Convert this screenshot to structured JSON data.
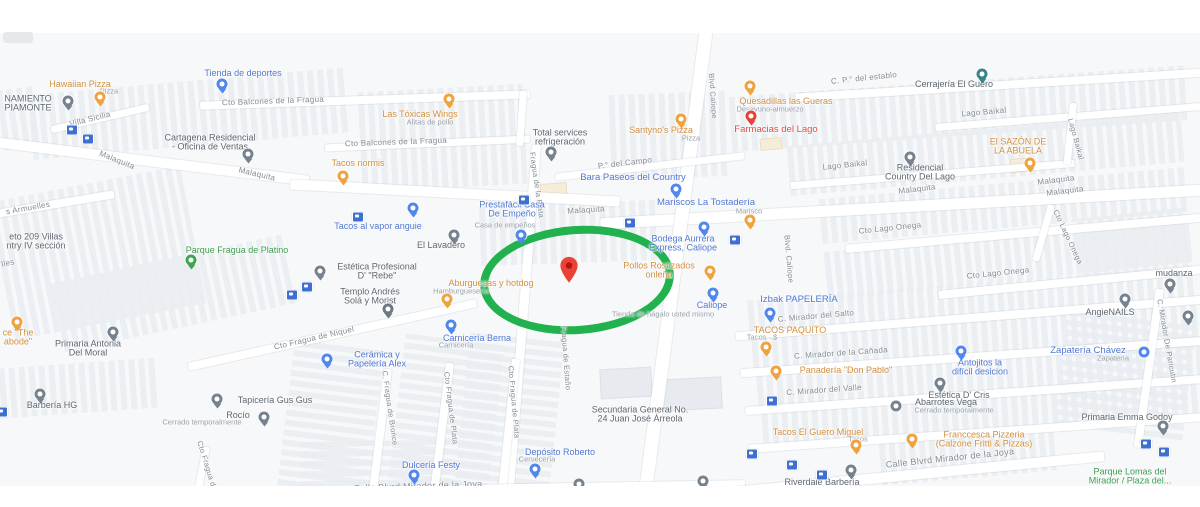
{
  "map": {
    "colors": {
      "background": "#f7f8fa",
      "road": "#ffffff",
      "street_label": "#828a94",
      "poi_food": "#d28f3e",
      "poi_shop": "#5077d2",
      "poi_generic": "#5d6670",
      "poi_red": "#df4b41",
      "poi_park": "#3d9c50",
      "highlight_circle": "#21b14e",
      "destination_marker": "#ea4335"
    },
    "streets": [
      {
        "t": "Villa Sicilia",
        "x": 90,
        "y": 86,
        "r": -14
      },
      {
        "t": "Cto Balcones de la Fragua",
        "x": 273,
        "y": 68,
        "r": -2
      },
      {
        "t": "Cto Balcones de la Fragua",
        "x": 396,
        "y": 109,
        "r": -2
      },
      {
        "t": "Malaquita",
        "x": 117,
        "y": 127,
        "r": 22
      },
      {
        "t": "Malaquita",
        "x": 257,
        "y": 141,
        "r": 13
      },
      {
        "t": "Malaquita",
        "x": 586,
        "y": 177,
        "r": -4
      },
      {
        "t": "Malaquita",
        "x": 917,
        "y": 156,
        "r": -7
      },
      {
        "t": "Malaquita",
        "x": 1056,
        "y": 147,
        "r": -7
      },
      {
        "t": "Malaquita",
        "x": 1065,
        "y": 158,
        "r": -7
      },
      {
        "t": "C. P.° del establo",
        "x": 864,
        "y": 45,
        "r": -6
      },
      {
        "t": "Lago Baikal",
        "x": 984,
        "y": 79,
        "r": -5
      },
      {
        "t": "Lago Baikal",
        "x": 845,
        "y": 132,
        "r": -6
      },
      {
        "t": "Cto Lago Onega",
        "x": 890,
        "y": 195,
        "r": -6
      },
      {
        "t": "Cto Lago Onega",
        "x": 998,
        "y": 240,
        "r": -6
      },
      {
        "t": "P.° del Campo",
        "x": 625,
        "y": 130,
        "r": -7
      },
      {
        "t": "s Armuelles",
        "x": 28,
        "y": 175,
        "r": -10
      },
      {
        "t": "lles",
        "x": 8,
        "y": 230,
        "r": -12
      },
      {
        "t": "Cto Fragua de Niquel",
        "x": 314,
        "y": 305,
        "r": -13
      },
      {
        "t": "Calle Blvrd Mirador de la Joya",
        "x": 418,
        "y": 453,
        "r": -2,
        "fs": 9
      },
      {
        "t": "Calle Blvrd Mirador de la Joya",
        "x": 950,
        "y": 425,
        "r": -6,
        "fs": 9
      },
      {
        "t": "C. Mirador del Salto",
        "x": 816,
        "y": 283,
        "r": -5
      },
      {
        "t": "C. Mirador de la Cañada",
        "x": 841,
        "y": 320,
        "r": -4
      },
      {
        "t": "C. Mirador del Valle",
        "x": 824,
        "y": 357,
        "r": -4
      },
      {
        "t": "Fragua de la Plata",
        "x": 537,
        "y": 152,
        "r": 82,
        "fs": 7.5
      },
      {
        "t": "Fragua de Estaño",
        "x": 566,
        "y": 325,
        "r": 86,
        "fs": 7.5
      },
      {
        "t": "C. Fragua de Bronce",
        "x": 390,
        "y": 375,
        "r": 82,
        "fs": 7.5
      },
      {
        "t": "Cto Fragua de Plata",
        "x": 451,
        "y": 375,
        "r": 83,
        "fs": 7.5
      },
      {
        "t": "Cto Fragua de Plata",
        "x": 514,
        "y": 369,
        "r": 85,
        "fs": 7.5
      },
      {
        "t": "Cto Fragua de Niquel",
        "x": 211,
        "y": 445,
        "r": 73,
        "fs": 7.5
      },
      {
        "t": "Blvd Caliope",
        "x": 713,
        "y": 63,
        "r": 86,
        "fs": 7.5
      },
      {
        "t": "Blvd. Caliope",
        "x": 789,
        "y": 226,
        "r": 85,
        "fs": 7.5
      },
      {
        "t": "Lago Baikal",
        "x": 1076,
        "y": 106,
        "r": 75,
        "fs": 7.5
      },
      {
        "t": "Cto Lago Onega",
        "x": 1068,
        "y": 204,
        "r": 65,
        "fs": 7.5
      },
      {
        "t": "C. Mirador De Paricutin",
        "x": 1167,
        "y": 308,
        "r": 80,
        "fs": 7.5
      }
    ],
    "pois": [
      {
        "type": "food",
        "t": [
          "Hawaiian Pizza"
        ],
        "x": 80,
        "y": 51,
        "sub": {
          "t": "Pizza",
          "x": 109,
          "y": 58
        },
        "pin": {
          "k": "food",
          "x": 100,
          "y": 64
        }
      },
      {
        "type": "food",
        "t": [
          "Las Tóxicas Wings"
        ],
        "x": 420,
        "y": 81,
        "sub": {
          "t": "Alitas de pollo",
          "x": 430,
          "y": 89
        },
        "pin": {
          "k": "food",
          "x": 449,
          "y": 66
        }
      },
      {
        "type": "food",
        "t": [
          "Tacos normis"
        ],
        "x": 358,
        "y": 130,
        "pin": {
          "k": "food",
          "x": 343,
          "y": 143
        }
      },
      {
        "type": "food",
        "t": [
          "Santyno's Pizza"
        ],
        "x": 661,
        "y": 97,
        "sub": {
          "t": "Pizza",
          "x": 691,
          "y": 105
        },
        "pin": {
          "k": "food",
          "x": 681,
          "y": 86
        }
      },
      {
        "type": "food",
        "t": [
          "Quesadillas las Gueras"
        ],
        "x": 786,
        "y": 68,
        "sub": {
          "t": "Desayuno-almuerzo",
          "x": 770,
          "y": 76
        },
        "pin": {
          "k": "food",
          "x": 750,
          "y": 53
        }
      },
      {
        "type": "food",
        "t": [
          "El SAZÓN DE",
          "LA ABUELA"
        ],
        "x": 1018,
        "y": 113,
        "pin": {
          "k": "food",
          "x": 1030,
          "y": 130
        }
      },
      {
        "type": "food",
        "t": [
          "Pollos Rostizados",
          "onleña"
        ],
        "x": 659,
        "y": 237,
        "pin": {
          "k": "food",
          "x": 710,
          "y": 238
        }
      },
      {
        "type": "food",
        "t": [
          "Aburguesas y hotdog"
        ],
        "x": 491,
        "y": 250,
        "sub": {
          "t": "Hamburguesería",
          "x": 461,
          "y": 258
        },
        "pin": {
          "k": "food",
          "x": 447,
          "y": 266
        }
      },
      {
        "type": "food",
        "t": [
          "TACOS PAQUITO"
        ],
        "x": 790,
        "y": 297,
        "sub": {
          "t": "Tacos · $",
          "x": 762,
          "y": 304
        },
        "pin": {
          "k": "food",
          "x": 766,
          "y": 314
        }
      },
      {
        "type": "food",
        "t": [
          "Panadería \"Don Pablo\""
        ],
        "x": 846,
        "y": 337,
        "pin": {
          "k": "food",
          "x": 776,
          "y": 338
        }
      },
      {
        "type": "food",
        "t": [
          "Tacos El Guero Miguel"
        ],
        "x": 818,
        "y": 399,
        "sub": {
          "t": "Tacos",
          "x": 858,
          "y": 406
        },
        "pin": {
          "k": "food",
          "x": 856,
          "y": 412
        }
      },
      {
        "type": "food",
        "t": [
          "Franccesca Pizzeria",
          "(Calzone Fritti & Pizzas)"
        ],
        "x": 984,
        "y": 406,
        "pin": {
          "k": "food",
          "x": 912,
          "y": 406
        }
      },
      {
        "type": "food",
        "t": [
          "Tacos Ingrid"
        ],
        "x": 777,
        "y": 461
      },
      {
        "type": "food",
        "t": [
          "ce \"The",
          "abode\""
        ],
        "x": 18,
        "y": 304,
        "pin": {
          "k": "food",
          "x": 17,
          "y": 289
        }
      },
      {
        "type": "food",
        "t": [],
        "pin": {
          "k": "food",
          "x": 750,
          "y": 187
        }
      },
      {
        "type": "shop",
        "t": [
          "Tienda de deportes"
        ],
        "x": 243,
        "y": 40,
        "pin": {
          "k": "shop",
          "x": 222,
          "y": 51
        }
      },
      {
        "type": "shop",
        "t": [
          "Tacos al vapor anguie"
        ],
        "x": 378,
        "y": 193
      },
      {
        "type": "shop",
        "t": [
          "Prestafácil Casa",
          "De Empeño"
        ],
        "x": 512,
        "y": 176,
        "sub": {
          "t": "Casa de empeños",
          "x": 505,
          "y": 192
        },
        "pin": {
          "k": "shop",
          "x": 521,
          "y": 202
        }
      },
      {
        "type": "shop",
        "t": [
          "Bodega Aurrera",
          "Express, Caliope"
        ],
        "x": 683,
        "y": 210,
        "pin": {
          "k": "shop",
          "x": 704,
          "y": 194
        }
      },
      {
        "type": "shop",
        "t": [
          "Bara Paseos del Country"
        ],
        "x": 633,
        "y": 145,
        "fs": 9.5,
        "pin": {
          "k": "shop",
          "x": 676,
          "y": 156
        }
      },
      {
        "type": "shop",
        "t": [
          "Mariscos La Tostadería"
        ],
        "x": 706,
        "y": 170,
        "fs": 9.5,
        "sub": {
          "t": "Marisco",
          "x": 749,
          "y": 178
        }
      },
      {
        "type": "shop",
        "t": [
          "Caliope"
        ],
        "x": 712,
        "y": 272,
        "sub": {
          "t": "Tienda de hágalo usted mismo",
          "x": 663,
          "y": 281
        },
        "pin": {
          "k": "shop",
          "x": 713,
          "y": 260
        }
      },
      {
        "type": "shop",
        "t": [
          "Izbak PAPELERÍA"
        ],
        "x": 799,
        "y": 267,
        "fs": 9.5,
        "pin": {
          "k": "shop",
          "x": 770,
          "y": 280
        }
      },
      {
        "type": "shop",
        "t": [
          "Antojitos la",
          "difícil desicion"
        ],
        "x": 980,
        "y": 334,
        "pin": {
          "k": "shop",
          "x": 961,
          "y": 318
        }
      },
      {
        "type": "shop",
        "t": [
          "Zapatería Chávez"
        ],
        "x": 1088,
        "y": 318,
        "fs": 9.5,
        "sub": {
          "t": "Zapatería",
          "x": 1113,
          "y": 325
        },
        "pin": {
          "k": "shop",
          "x": 1144,
          "y": 319,
          "circ": true
        }
      },
      {
        "type": "shop",
        "t": [
          "Cerámica y",
          "Papelería Alex"
        ],
        "x": 377,
        "y": 326,
        "pin": {
          "k": "shop",
          "x": 327,
          "y": 326
        }
      },
      {
        "type": "shop",
        "t": [
          "Carnicería Berna"
        ],
        "x": 477,
        "y": 305,
        "sub": {
          "t": "Carnicería",
          "x": 456,
          "y": 312
        },
        "pin": {
          "k": "shop",
          "x": 451,
          "y": 292
        }
      },
      {
        "type": "shop",
        "t": [
          "Dulcería Festy"
        ],
        "x": 431,
        "y": 432,
        "pin": {
          "k": "shop",
          "x": 414,
          "y": 442
        }
      },
      {
        "type": "shop",
        "t": [
          "Depósito Roberto"
        ],
        "x": 560,
        "y": 419,
        "sub": {
          "t": "Cervecería",
          "x": 537,
          "y": 426
        },
        "pin": {
          "k": "shop",
          "x": 535,
          "y": 436
        }
      },
      {
        "type": "shop",
        "t": [
          "Tintes Mary"
        ],
        "x": 992,
        "y": 464
      },
      {
        "type": "shop",
        "t": [],
        "pin": {
          "k": "shop",
          "x": 413,
          "y": 175
        }
      },
      {
        "type": "gen",
        "t": [
          "NAMIENTO",
          "PIAMONTE"
        ],
        "x": 28,
        "y": 70,
        "pin": {
          "k": "gen",
          "x": 68,
          "y": 68
        }
      },
      {
        "type": "gen",
        "t": [
          "Cartagena Residencial",
          "- Oficina de Ventas"
        ],
        "x": 210,
        "y": 109,
        "pin": {
          "k": "gen",
          "x": 248,
          "y": 121
        }
      },
      {
        "type": "gen",
        "t": [
          "Total services",
          "refrigeración"
        ],
        "x": 560,
        "y": 104,
        "pin": {
          "k": "gen",
          "x": 551,
          "y": 119
        }
      },
      {
        "type": "gen",
        "t": [
          "Cerrajería El Guero"
        ],
        "x": 954,
        "y": 51,
        "pin": {
          "k": "teal",
          "x": 982,
          "y": 41
        }
      },
      {
        "type": "gen",
        "t": [
          "Residencial",
          "Country Del Lago"
        ],
        "x": 920,
        "y": 139,
        "pin": {
          "k": "gen",
          "x": 910,
          "y": 124
        }
      },
      {
        "type": "gen",
        "t": [
          "El Lavadero"
        ],
        "x": 441,
        "y": 212,
        "pin": {
          "k": "gen",
          "x": 454,
          "y": 202
        }
      },
      {
        "type": "gen",
        "t": [
          "Estética Profesional",
          "D' \"Rebe\""
        ],
        "x": 377,
        "y": 238,
        "pin": {
          "k": "gen",
          "x": 320,
          "y": 238
        }
      },
      {
        "type": "gen",
        "t": [
          "Templo Andrés",
          "Solá y Morist"
        ],
        "x": 370,
        "y": 263,
        "pin": {
          "k": "church",
          "x": 388,
          "y": 276
        }
      },
      {
        "type": "park",
        "t": [
          "Parque Fragua de Platino"
        ],
        "x": 237,
        "y": 217,
        "pin": {
          "k": "park",
          "x": 191,
          "y": 227
        }
      },
      {
        "type": "gen",
        "t": [
          "Primaria Antonia",
          "Del Moral"
        ],
        "x": 88,
        "y": 315,
        "pin": {
          "k": "gen",
          "x": 113,
          "y": 299
        }
      },
      {
        "type": "gen",
        "t": [
          "Barbería HG"
        ],
        "x": 52,
        "y": 372,
        "pin": {
          "k": "gen",
          "x": 40,
          "y": 361
        }
      },
      {
        "type": "gen",
        "t": [
          "Tapicería Gus Gus"
        ],
        "x": 275,
        "y": 367,
        "pin": {
          "k": "gen",
          "x": 217,
          "y": 366
        }
      },
      {
        "type": "gen",
        "t": [
          "Rocío"
        ],
        "x": 238,
        "y": 382,
        "sub": {
          "t": "Cerrado temporalmente",
          "x": 202,
          "y": 389
        },
        "pin": {
          "k": "gen",
          "x": 264,
          "y": 384
        }
      },
      {
        "type": "gen",
        "t": [
          "Secundaria General No.",
          "24 Juan José Árreola"
        ],
        "x": 640,
        "y": 381,
        "fs": 9
      },
      {
        "type": "gen",
        "t": [
          "Estética \"Maru\""
        ],
        "x": 556,
        "y": 463,
        "pin": {
          "k": "gen",
          "x": 579,
          "y": 451
        }
      },
      {
        "type": "gen",
        "t": [
          "Ignacio Garcia Tellez"
        ],
        "x": 672,
        "y": 461,
        "pin": {
          "k": "gen",
          "x": 703,
          "y": 448
        }
      },
      {
        "type": "gen",
        "t": [
          "Riverdale Barbería"
        ],
        "x": 822,
        "y": 449,
        "pin": {
          "k": "gen",
          "x": 851,
          "y": 437
        }
      },
      {
        "type": "gen",
        "t": [
          "Primaria Emma Godoy"
        ],
        "x": 1127,
        "y": 384,
        "pin": {
          "k": "gen",
          "x": 1163,
          "y": 393
        }
      },
      {
        "type": "gen",
        "t": [
          "AngieNAILS"
        ],
        "x": 1110,
        "y": 279,
        "pin": {
          "k": "gen",
          "x": 1125,
          "y": 266
        }
      },
      {
        "type": "gen",
        "t": [
          "mudanza"
        ],
        "x": 1174,
        "y": 240,
        "pin": {
          "k": "gen",
          "x": 1170,
          "y": 251
        }
      },
      {
        "type": "gen",
        "t": [
          "Estética D' Cris"
        ],
        "x": 959,
        "y": 362,
        "pin": {
          "k": "gen",
          "x": 940,
          "y": 350
        }
      },
      {
        "type": "gen",
        "t": [
          "Abarrotes Vega"
        ],
        "x": 946,
        "y": 369,
        "sub": {
          "t": "Cerrado temporalmente",
          "x": 954,
          "y": 377
        },
        "pin": {
          "k": "gen",
          "x": 896,
          "y": 373,
          "circ": true
        }
      },
      {
        "type": "red",
        "t": [
          "Farmacias del Lago"
        ],
        "x": 776,
        "y": 97,
        "fs": 9.5,
        "pin": {
          "k": "red",
          "x": 751,
          "y": 83
        }
      },
      {
        "type": "park",
        "t": [
          "Parque Lomas del",
          "Mirador / Plaza del..."
        ],
        "x": 1130,
        "y": 443,
        "pin": {
          "k": "park",
          "x": 1107,
          "y": 459
        }
      },
      {
        "type": "gen",
        "t": [
          "eto 209 Villas",
          "ntry IV sección"
        ],
        "x": 36,
        "y": 208
      },
      {
        "type": "gen",
        "t": [],
        "pin": {
          "k": "gen",
          "x": 1188,
          "y": 283
        }
      }
    ],
    "transit_icons": [
      {
        "x": 72,
        "y": 97
      },
      {
        "x": 88,
        "y": 106
      },
      {
        "x": 292,
        "y": 262
      },
      {
        "x": 307,
        "y": 254
      },
      {
        "x": 358,
        "y": 184
      },
      {
        "x": 630,
        "y": 190
      },
      {
        "x": 735,
        "y": 207
      },
      {
        "x": 772,
        "y": 368
      },
      {
        "x": 752,
        "y": 421
      },
      {
        "x": 792,
        "y": 432
      },
      {
        "x": 822,
        "y": 442
      },
      {
        "x": 1146,
        "y": 411
      },
      {
        "x": 1164,
        "y": 419
      },
      {
        "x": 2,
        "y": 379
      },
      {
        "x": 524,
        "y": 167
      }
    ],
    "highlight": {
      "circle_color": "#21b14e",
      "marker_color": "#ea4335",
      "marker_dot_color": "#b31412"
    }
  }
}
